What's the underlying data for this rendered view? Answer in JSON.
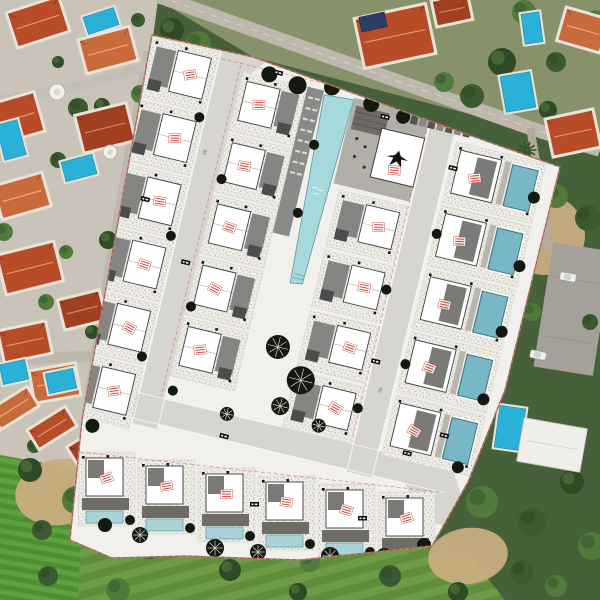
{
  "scene": {
    "title": "Aerial view of villa development masterplan overlaid on satellite photo",
    "type": "architectural-site-plan-overlay"
  },
  "labels": {
    "road_label": "SC"
  },
  "colors": {
    "base_green": "#46603a",
    "field_green": "#6f9a46",
    "field_stripe": "#618c3c",
    "lawn_green": "#4f8f33",
    "lawn_stripe": "#5da23e",
    "tree_green": "#3b5a31",
    "scrub_dark": "#2f4a26",
    "dirt_tan": "#c9ad80",
    "photo_ground": "#c9c3b9",
    "top_ground": "#87926a",
    "photo_road": "#bdb7ad",
    "asphalt": "#a5a19a",
    "roof_red": "#b84c27",
    "roof_orange": "#c96a3a",
    "roof_deep": "#a04020",
    "pool_cyan": "#29b1d8",
    "car_white": "#eef0ee",
    "plan_paper": "#f1f0ec",
    "plan_road": "#d7d5d0",
    "deck_dark": "#8a8a88",
    "plaza_gray": "#b2afa8",
    "building_white": "#ffffff",
    "roof_gray": "#7a7a78",
    "deck_gray": "#8e8b86",
    "communal_pool": "#a6d9dc",
    "private_pool": "#78b7c6",
    "pale_pool": "#a9d3d8",
    "plan_tree": "#14190f",
    "stamp_red": "#c23b2e",
    "dash_red": "#d23c2e",
    "chip_black": "#0d0d0d"
  },
  "features": {
    "plan_villa_plots": 26,
    "bottom_row_villas": 6,
    "communal_pools": 1,
    "private_pools_in_plan": 11,
    "existing_villas_photo": 16,
    "existing_pools_photo": 8,
    "visible_cars": 2,
    "red_unit_stamps": 28
  },
  "plan": {
    "rotation_deg": 13.5,
    "center_x": 318,
    "center_y": 300,
    "boundary_path": "M152,35 L253,57 L483,140 L560,167 L505,390 L468,482 L432,546 L300,560 L185,556 L112,558 L70,540 L82,420 Z",
    "columns": [
      {
        "name": "left-edge-row",
        "x": -222,
        "y": -218,
        "w": 68,
        "h": 62,
        "step": 65,
        "count": 6,
        "side": "r",
        "pool": false
      },
      {
        "name": "mid-left-row",
        "x": -126,
        "y": -204,
        "w": 66,
        "h": 60,
        "step": 63,
        "count": 5,
        "side": "l",
        "pool": false
      },
      {
        "name": "mid-right-row",
        "x": -5,
        "y": -112,
        "w": 70,
        "h": 58,
        "step": 62,
        "count": 4,
        "side": "r",
        "pool": false
      },
      {
        "name": "right-edge-row",
        "x": 98,
        "y": -186,
        "w": 92,
        "h": 62,
        "step": 65,
        "count": 5,
        "side": "l",
        "pool": true
      }
    ],
    "bottom_row": {
      "x": 78,
      "y": 452,
      "w": 57,
      "h": 74,
      "step_x": 60,
      "step_y": 8,
      "count": 6
    },
    "communal_pool_pts": "-42,-201 -12,-203 -19,-12 -31,-10",
    "trees_local": [
      [
        -100,
        -208,
        8,
        0
      ],
      [
        -70,
        -204,
        9,
        0
      ],
      [
        -36,
        -210,
        8,
        0
      ],
      [
        6,
        -203,
        8,
        0
      ],
      [
        40,
        -198,
        7,
        0
      ],
      [
        -158,
        -150,
        5,
        0
      ],
      [
        -122,
        -95,
        5,
        0
      ],
      [
        -158,
        -28,
        5,
        0
      ],
      [
        -122,
        36,
        5,
        0
      ],
      [
        -158,
        96,
        5,
        0
      ],
      [
        -120,
        122,
        5,
        0
      ],
      [
        100,
        -92,
        5,
        0
      ],
      [
        64,
        -26,
        5,
        0
      ],
      [
        100,
        42,
        5,
        0
      ],
      [
        64,
        96,
        5,
        0
      ],
      [
        186,
        -150,
        6,
        0
      ],
      [
        188,
        -80,
        6,
        0
      ],
      [
        186,
        -12,
        6,
        0
      ],
      [
        184,
        58,
        6,
        0
      ],
      [
        -28,
        55,
        12,
        1
      ],
      [
        2,
        82,
        14,
        1
      ],
      [
        -12,
        112,
        9,
        1
      ],
      [
        30,
        122,
        7,
        1
      ],
      [
        -62,
        132,
        7,
        1
      ],
      [
        -190,
        175,
        7,
        0
      ],
      [
        -40,
        -150,
        5,
        0
      ],
      [
        -40,
        -80,
        5,
        0
      ],
      [
        150,
        170,
        7,
        0
      ],
      [
        175,
        130,
        6,
        0
      ]
    ],
    "trees_abs": [
      [
        215,
        548,
        9,
        1
      ],
      [
        258,
        552,
        8,
        1
      ],
      [
        330,
        556,
        9,
        1
      ],
      [
        384,
        556,
        8,
        1
      ],
      [
        424,
        545,
        7,
        0
      ],
      [
        140,
        535,
        8,
        1
      ],
      [
        105,
        525,
        7,
        0
      ]
    ],
    "chips_local": [
      [
        -96,
        -214
      ],
      [
        18,
        -196
      ],
      [
        96,
        -162
      ],
      [
        -142,
        -8
      ],
      [
        66,
        44
      ],
      [
        -64,
        152
      ],
      [
        118,
        126
      ],
      [
        -196,
        -60
      ],
      [
        150,
        100
      ]
    ],
    "chips_abs": [
      [
        250,
        502
      ],
      [
        358,
        516
      ]
    ],
    "extra_stamps_local": [
      [
        44,
        -144
      ]
    ],
    "loungers": {
      "x": -57,
      "y": -196,
      "rows": 8,
      "cols": 2,
      "step": 11
    },
    "parking_stalls": {
      "x": 48,
      "y": -206,
      "count": 7,
      "step": 9
    }
  },
  "photo": {
    "villas": [
      [
        38,
        22,
        52,
        34,
        -18,
        "roof_red"
      ],
      [
        108,
        50,
        50,
        32,
        -15,
        "roof_orange"
      ],
      [
        16,
        118,
        46,
        38,
        -16,
        "roof_red"
      ],
      [
        105,
        128,
        50,
        36,
        -14,
        "roof_deep"
      ],
      [
        22,
        196,
        48,
        32,
        -16,
        "roof_orange"
      ],
      [
        30,
        268,
        56,
        38,
        -14,
        "roof_red"
      ],
      [
        82,
        310,
        40,
        28,
        -14,
        "roof_deep"
      ],
      [
        25,
        342,
        46,
        30,
        -12,
        "roof_red"
      ],
      [
        55,
        383,
        44,
        30,
        -10,
        "roof_orange"
      ],
      [
        14,
        408,
        42,
        20,
        -32,
        "roof_orange"
      ],
      [
        52,
        428,
        42,
        20,
        -32,
        "roof_red"
      ],
      [
        90,
        446,
        38,
        20,
        -32,
        "roof_deep"
      ],
      [
        395,
        36,
        70,
        48,
        -12,
        "roof_red"
      ],
      [
        583,
        30,
        42,
        32,
        16,
        "roof_orange"
      ],
      [
        573,
        133,
        46,
        36,
        -12,
        "roof_red"
      ],
      [
        452,
        10,
        34,
        24,
        -12,
        "roof_deep"
      ]
    ],
    "pools": [
      [
        101,
        21,
        32,
        18,
        -18
      ],
      [
        11,
        140,
        22,
        36,
        -15
      ],
      [
        79,
        168,
        32,
        20,
        -15
      ],
      [
        14,
        372,
        26,
        20,
        -12
      ],
      [
        61,
        381,
        28,
        20,
        -12
      ],
      [
        532,
        28,
        18,
        30,
        -8
      ],
      [
        518,
        92,
        30,
        36,
        -10
      ],
      [
        510,
        428,
        26,
        42,
        8
      ]
    ],
    "tanks": [
      [
        57,
        92,
        8
      ],
      [
        110,
        152,
        7
      ]
    ],
    "palm": [
      527,
      150
    ],
    "cars": [
      [
        568,
        277,
        10
      ],
      [
        538,
        355,
        12
      ]
    ],
    "trees": [
      [
        78,
        108,
        10
      ],
      [
        102,
        106,
        8
      ],
      [
        140,
        94,
        9
      ],
      [
        58,
        160,
        8
      ],
      [
        108,
        240,
        9
      ],
      [
        66,
        252,
        7
      ],
      [
        128,
        300,
        8
      ],
      [
        92,
        332,
        7
      ],
      [
        46,
        302,
        8
      ],
      [
        138,
        20,
        7
      ],
      [
        58,
        62,
        6
      ],
      [
        4,
        232,
        9
      ],
      [
        34,
        446,
        7
      ],
      [
        172,
        30,
        12
      ],
      [
        198,
        44,
        13
      ],
      [
        224,
        58,
        11
      ],
      [
        252,
        72,
        12
      ],
      [
        286,
        84,
        10
      ],
      [
        318,
        95,
        11
      ],
      [
        344,
        103,
        9
      ],
      [
        444,
        82,
        10
      ],
      [
        472,
        96,
        12
      ],
      [
        502,
        62,
        14
      ],
      [
        524,
        12,
        12
      ],
      [
        556,
        62,
        10
      ],
      [
        548,
        110,
        9
      ],
      [
        596,
        20,
        10
      ],
      [
        490,
        182,
        12
      ],
      [
        522,
        202,
        14
      ],
      [
        556,
        196,
        12
      ],
      [
        588,
        218,
        13
      ],
      [
        502,
        232,
        10
      ],
      [
        532,
        312,
        9
      ],
      [
        590,
        322,
        8
      ],
      [
        480,
        254,
        9
      ],
      [
        482,
        502,
        16
      ],
      [
        532,
        522,
        14
      ],
      [
        572,
        482,
        12
      ],
      [
        592,
        546,
        14
      ],
      [
        522,
        572,
        12
      ],
      [
        458,
        592,
        10
      ],
      [
        556,
        586,
        11
      ],
      [
        150,
        546,
        13
      ],
      [
        230,
        570,
        11
      ],
      [
        310,
        562,
        10
      ],
      [
        390,
        576,
        11
      ],
      [
        298,
        592,
        9
      ],
      [
        118,
        590,
        12
      ],
      [
        48,
        576,
        10
      ],
      [
        30,
        470,
        12
      ],
      [
        76,
        500,
        14
      ],
      [
        42,
        530,
        10
      ],
      [
        108,
        470,
        8
      ]
    ],
    "dirt": [
      [
        545,
        235,
        80,
        80,
        10
      ],
      [
        468,
        556,
        80,
        56,
        -8
      ],
      [
        60,
        492,
        90,
        66,
        -10
      ],
      [
        120,
        455,
        40,
        30,
        0
      ]
    ],
    "solar_panel": [
      373,
      22,
      26,
      15,
      -12
    ],
    "white_villa": [
      552,
      445,
      64,
      44,
      10
    ],
    "parking_lot": [
      543,
      246,
      60,
      126,
      9
    ]
  }
}
